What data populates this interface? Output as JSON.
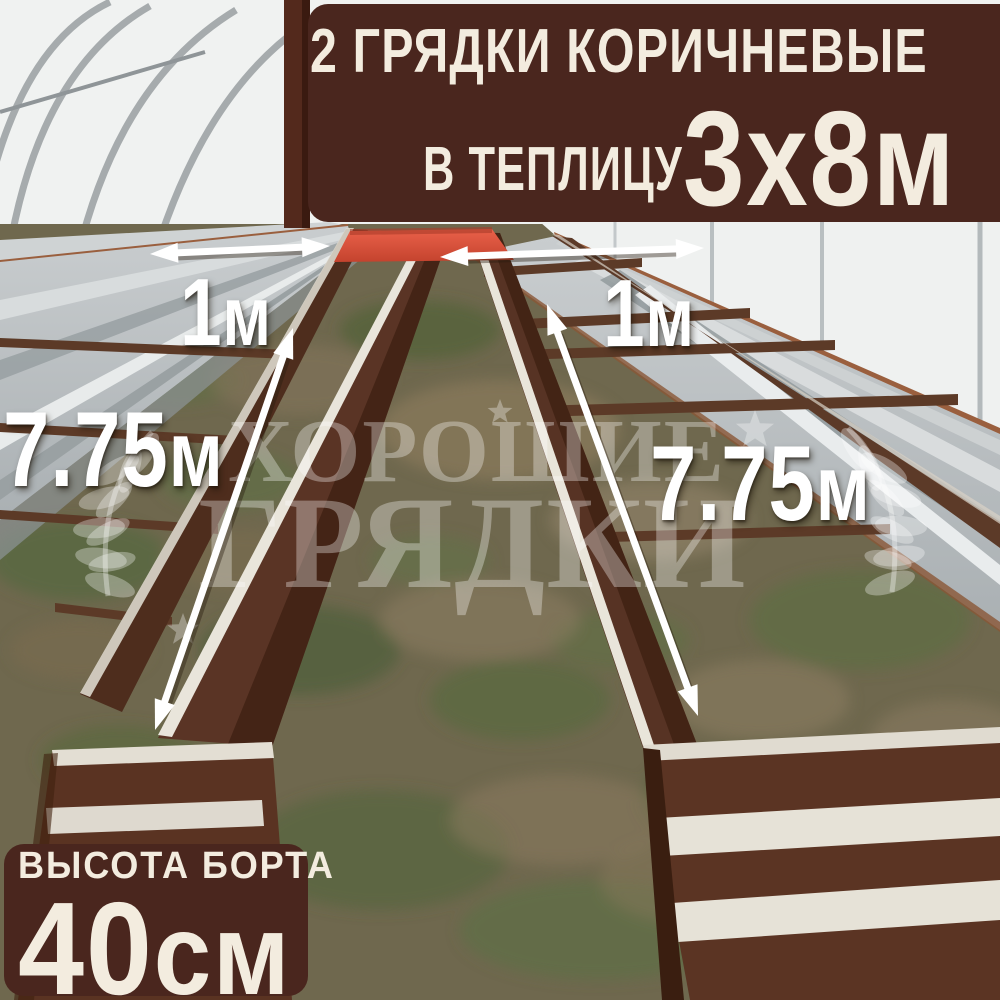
{
  "banner": {
    "line1": "2 ГРЯДКИ КОРИЧНЕВЫЕ",
    "line2_prefix": "В ТЕПЛИЦУ",
    "size": "3х8м"
  },
  "badge": {
    "title": "ВЫСОТА БОРТА",
    "value": "40",
    "unit": "см"
  },
  "dimensions": {
    "bed_width_left": {
      "value": "1",
      "unit": "м"
    },
    "bed_width_right": {
      "value": "1",
      "unit": "м"
    },
    "bed_length_left": {
      "value": "7.75",
      "unit": "м"
    },
    "bed_length_right": {
      "value": "7.75",
      "unit": "м"
    }
  },
  "watermark": {
    "line1": "ХОРОШИЕ",
    "line2": "ГРЯДКИ"
  },
  "colors": {
    "banner_bg": "#4a261e",
    "badge_bg": "#4a261e",
    "overlay_text": "#f3ecdf",
    "dimension_text": "#ffffff",
    "red_end_panel": "#dd5440",
    "bed_brown": "#5a3322",
    "galvanized": "#b9bec0"
  }
}
